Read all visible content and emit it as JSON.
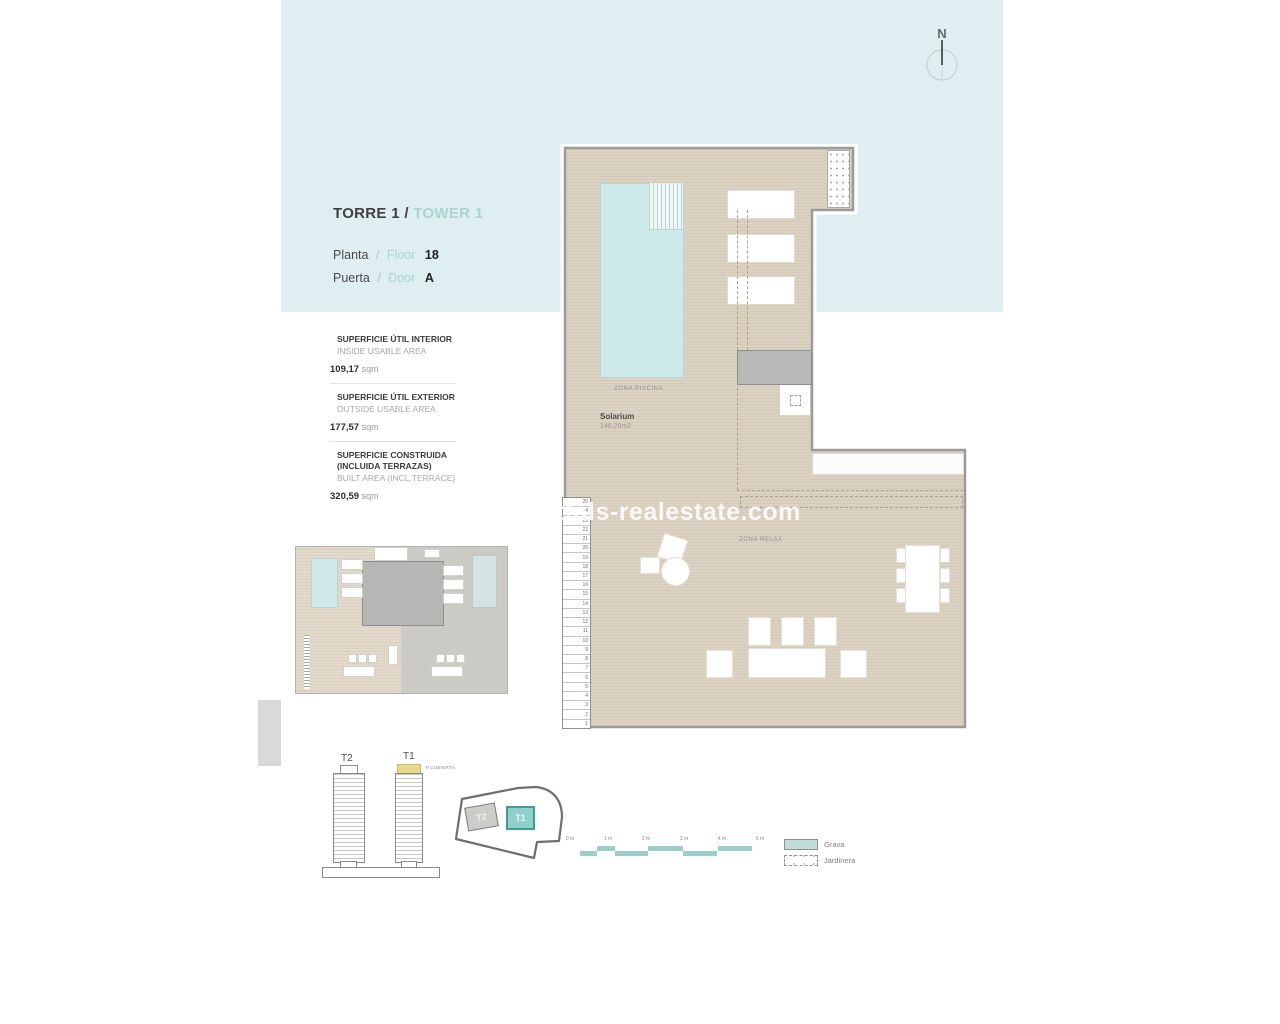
{
  "header": {
    "tower_es": "TORRE 1",
    "sep": "/",
    "tower_en": "TOWER 1",
    "floor_es": "Planta",
    "floor_en": "Floor",
    "floor_value": "18",
    "door_es": "Puerta",
    "door_en": "Door",
    "door_value": "A"
  },
  "areas": {
    "items": [
      {
        "es1": "SUPERFICIE ÚTIL INTERIOR",
        "es2": "",
        "en": "INSIDE USABLE AREA",
        "value": "109,17",
        "unit": "sqm"
      },
      {
        "es1": "SUPERFICIE ÚTIL EXTERIOR",
        "es2": "",
        "en": "OUTSIDE USABLE AREA",
        "value": "177,57",
        "unit": "sqm"
      },
      {
        "es1": "SUPERFICIE CONSTRUIDA",
        "es2": "(INCLUIDA TERRAZAS)",
        "en": "BUILT AREA (INCL.TERRACE)",
        "value": "320,59",
        "unit": "sqm"
      }
    ]
  },
  "north": {
    "label": "N"
  },
  "plan": {
    "zona_piscina": "ZONA PISCINA",
    "solarium_title": "Solarium",
    "solarium_area": "146,28m2",
    "zona_relax": "ZONA RELAX",
    "stair_numbers": [
      25,
      24,
      23,
      22,
      21,
      20,
      19,
      18,
      17,
      16,
      15,
      14,
      13,
      12,
      11,
      10,
      9,
      8,
      7,
      6,
      5,
      4,
      3,
      2,
      1
    ]
  },
  "watermark": {
    "text": "ttals-realestate.com"
  },
  "towers": {
    "t2": "T2",
    "t1": "T1",
    "roof": "P.CUBIERTA"
  },
  "site": {
    "t2": "T2",
    "t1": "T1"
  },
  "scale_bar": {
    "labels": [
      "0 m",
      "1 m",
      "2 m",
      "3 m",
      "4 m",
      "5 m"
    ]
  },
  "legend": {
    "items": [
      {
        "label": "Grava",
        "swatch": "solid"
      },
      {
        "label": "Jardinera",
        "swatch": "dashed"
      }
    ]
  },
  "colors": {
    "accent_teal": "#a7d5d2",
    "panel_cyan": "#dfeef0",
    "plan_floor": "#dcd2c2",
    "pool_blue": "#cde9ea",
    "legend_teal": "#c2dcda",
    "site_t1_fill": "#8fd0ca",
    "roof_cap_yellow": "#e9da8e"
  }
}
